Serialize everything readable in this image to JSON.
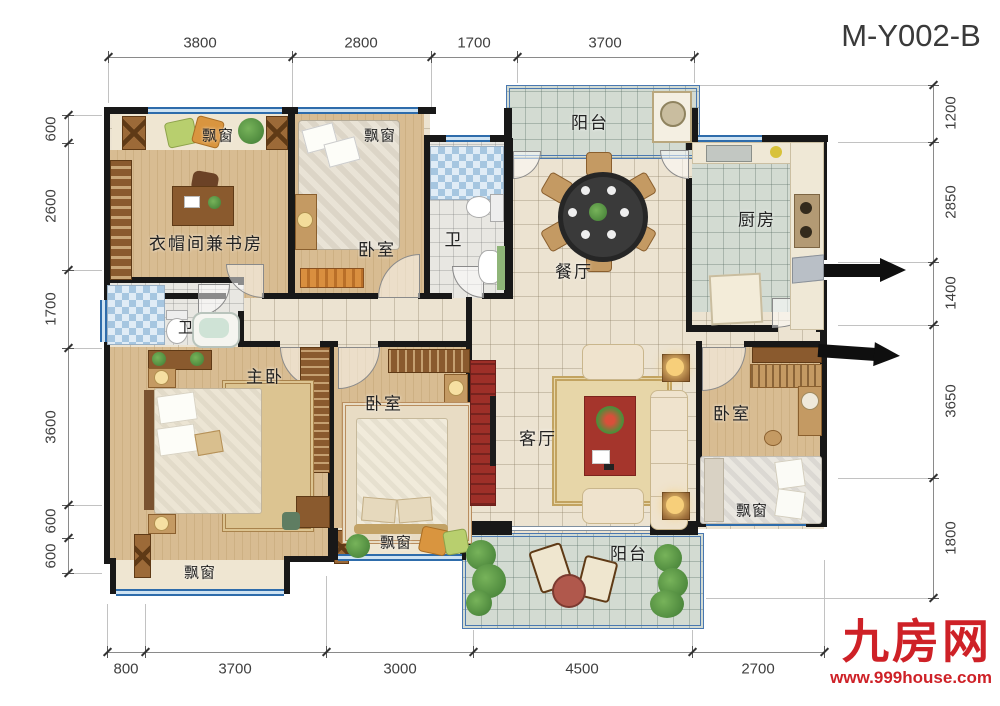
{
  "plan": {
    "code": "M-Y002-B"
  },
  "branding": {
    "site_name": "九房网",
    "site_url": "www.999house.com"
  },
  "dims": {
    "top": [
      "3800",
      "2800",
      "1700",
      "3700"
    ],
    "bottom": [
      "800",
      "3700",
      "3000",
      "4500",
      "2700"
    ],
    "left": [
      "600",
      "2600",
      "1700",
      "3600",
      "600",
      "600"
    ],
    "right": [
      "1200",
      "2850",
      "1400",
      "3650",
      "1800"
    ]
  },
  "rooms": {
    "study": "衣帽间兼书房",
    "bedroom_top": "卧室",
    "bath_top": "卫",
    "balcony_top": "阳台",
    "dining": "餐厅",
    "kitchen": "厨房",
    "master_bath": "卫",
    "master_bedroom": "主卧",
    "bedroom_mid": "卧室",
    "living": "客厅",
    "balcony_bottom": "阳台",
    "bedroom_right": "卧室"
  },
  "labels": {
    "bay_window": "飘窗"
  },
  "colors": {
    "wall": "#181818",
    "window_blue": "#2e6cab",
    "wood_floor": "#d8bc92",
    "tile_floor": "#ece3d1",
    "balcony_floor": "#d3dbd2",
    "accent_red": "#9e2f28",
    "brand_red": "#ce2127"
  }
}
